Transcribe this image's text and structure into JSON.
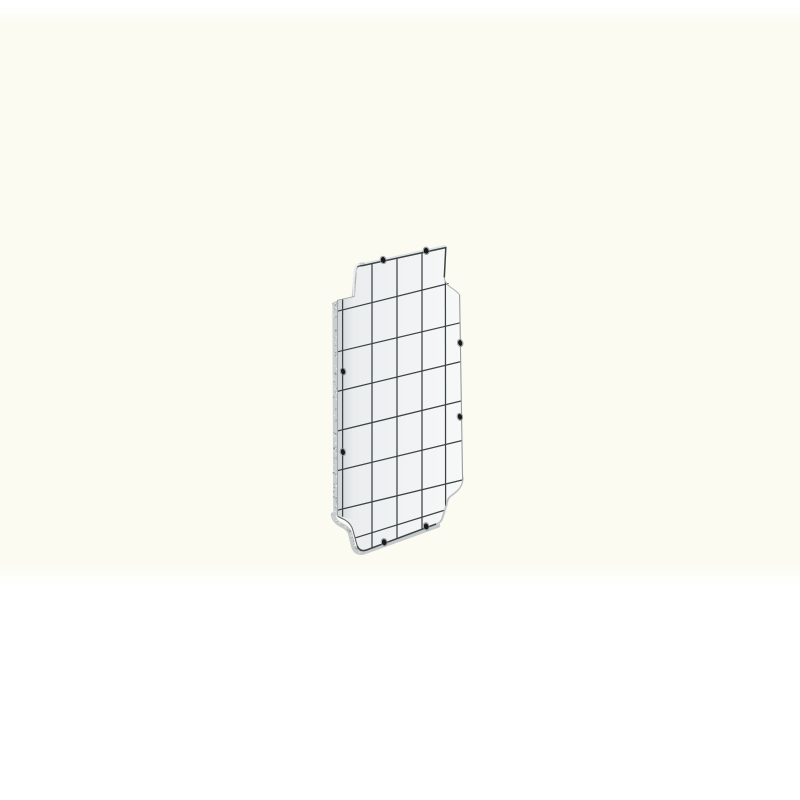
{
  "image": {
    "object": "enclosure-mounting-plate",
    "page_background": "#ffffff",
    "photo_background": "#fbfbf2",
    "colors": {
      "face_left": "#e9eced",
      "face_right": "#f7f9f9",
      "grid_line": "#3d4345",
      "edge_band": "#c5c9ca",
      "edge_band_light": "#dfe3e3",
      "edge_line_light": "#b4babc",
      "edge_line_medium": "#979da0",
      "step_inner_line": "#646a6c",
      "speckle_base": "#c9cdce",
      "speckle_dark": "#8d9496",
      "speckle_light": "#e9eceb",
      "hook_highlight": "#e9eceb",
      "hole_fill": "#17191a",
      "hole_ring": "#878d8f"
    },
    "grid": {
      "vlines": [
        [
          342.6,
          299.3,
          342.6,
          516.6
        ],
        [
          372.0,
          263.8,
          372.0,
          548.0
        ],
        [
          397.0,
          258.4,
          397.0,
          538.6
        ],
        [
          422.0,
          253.0,
          422.0,
          529.2
        ],
        [
          445.4,
          281.5,
          445.6,
          506.0
        ]
      ],
      "hlines": [
        [
          337.5,
          311.2,
          448.5,
          283.5
        ],
        [
          337.5,
          351.8,
          460.1,
          322.8
        ],
        [
          337.5,
          391.4,
          460.8,
          361.6
        ],
        [
          337.5,
          431.0,
          461.5,
          400.9
        ],
        [
          337.5,
          470.6,
          462.2,
          440.5
        ],
        [
          337.5,
          510.2,
          462.7,
          479.9
        ],
        [
          355.5,
          537.8,
          444.0,
          510.4
        ]
      ]
    },
    "holes": [
      [
        383.2,
        260.0,
        2.3,
        3.1
      ],
      [
        426.2,
        250.8,
        2.3,
        3.1
      ],
      [
        343.1,
        371.5,
        2.1,
        3.0
      ],
      [
        342.9,
        452.0,
        2.1,
        3.0
      ],
      [
        460.2,
        343.0,
        2.1,
        3.0
      ],
      [
        459.9,
        416.8,
        2.1,
        3.0
      ],
      [
        384.2,
        542.2,
        2.3,
        3.1
      ],
      [
        426.2,
        526.4,
        2.3,
        3.1
      ]
    ]
  }
}
